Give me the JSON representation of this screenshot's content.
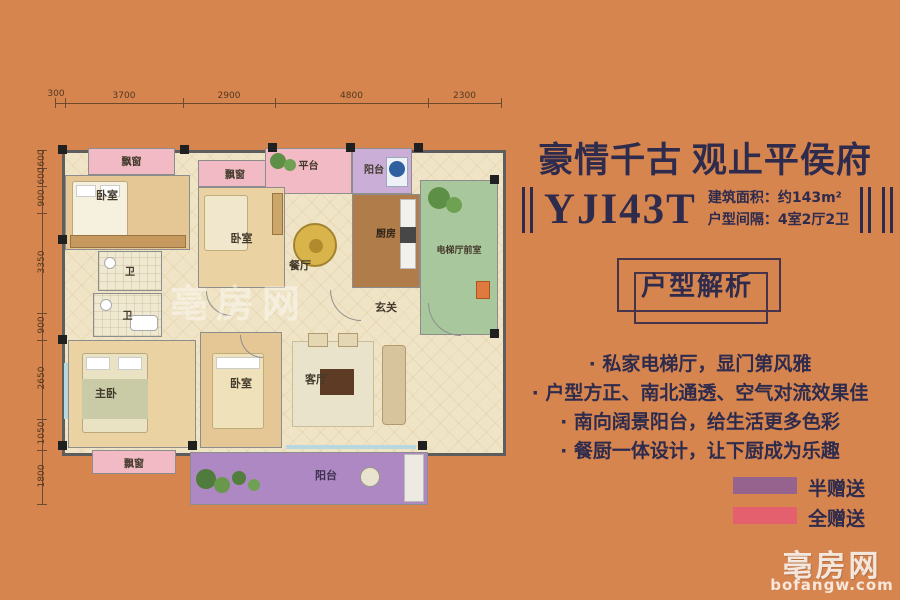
{
  "info": {
    "title": "豪情千古 观止平侯府",
    "model": "YJI43T",
    "area": "建筑面积：约143m²",
    "layout": "户型间隔：4室2厅2卫",
    "button": "户型解析",
    "features": [
      "· 私家电梯厅，显门第风雅",
      "· 户型方正、南北通透、空气对流效果佳",
      "· 南向阔景阳台，给生活更多色彩",
      "· 餐厨一体设计，让下厨成为乐趣"
    ]
  },
  "legend": [
    {
      "label": "半赠送",
      "color": "#96638f"
    },
    {
      "label": "全赠送",
      "color": "#e4606e"
    }
  ],
  "plan": {
    "dims_top": [
      "300",
      "3700",
      "2900",
      "4800",
      "2300"
    ],
    "dims_left": [
      "600",
      "600",
      "900",
      "3350",
      "900",
      "2650",
      "1050",
      "1800"
    ],
    "labels": {
      "bedroom_tl": "卧室",
      "bedroom_tm": "卧室",
      "bedroom_bm": "卧室",
      "master_bedroom": "主卧",
      "bath_upper": "卫",
      "bath_lower": "卫",
      "kitchen": "厨房",
      "dining": "餐厅",
      "living": "客厅",
      "foyer": "玄关",
      "elevator_lobby": "电梯厅前室",
      "platform": "平台",
      "balcony_top": "阳台",
      "balcony_main": "阳台",
      "bay_window_tl": "飘窗",
      "bay_window_tm": "飘窗",
      "bay_window_bottom": "飘窗"
    },
    "watermark": "亳房网"
  },
  "site_watermark": {
    "brand": "亳房网",
    "domain": "bofangw.com"
  },
  "colors": {
    "background": "#d6854f",
    "accent": "#2e2b4d"
  }
}
